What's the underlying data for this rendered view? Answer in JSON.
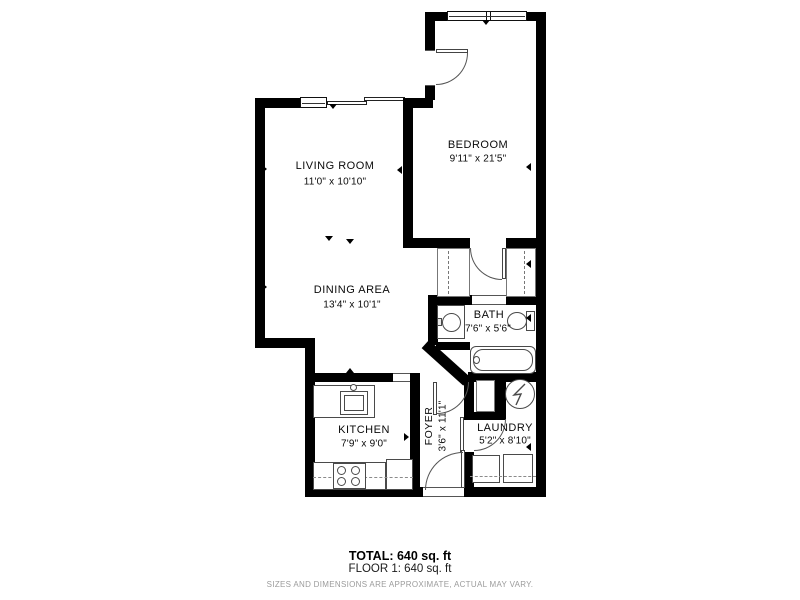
{
  "rooms": {
    "living_room": {
      "name": "LIVING ROOM",
      "dimensions": "11'0\" x 10'10\""
    },
    "bedroom": {
      "name": "BEDROOM",
      "dimensions": "9'11\" x 21'5\""
    },
    "dining_area": {
      "name": "DINING AREA",
      "dimensions": "13'4\" x 10'1\""
    },
    "bath": {
      "name": "BATH",
      "dimensions": "7'6\" x 5'6\""
    },
    "kitchen": {
      "name": "KITCHEN",
      "dimensions": "7'9\" x 9'0\""
    },
    "foyer": {
      "name": "FOYER",
      "dimensions": "3'6\" x 11'1\""
    },
    "laundry": {
      "name": "LAUNDRY",
      "dimensions": "5'2\" x 8'10\""
    }
  },
  "title_block": {
    "total": "TOTAL: 640 sq. ft",
    "floor": "FLOOR 1: 640 sq. ft",
    "disclaimer": "SIZES AND DIMENSIONS ARE APPROXIMATE, ACTUAL MAY VARY."
  },
  "colors": {
    "wall": "#000000",
    "background": "#ffffff",
    "fixture_outline": "#4a4a4a",
    "disclaimer_text": "#9b9b9b"
  }
}
